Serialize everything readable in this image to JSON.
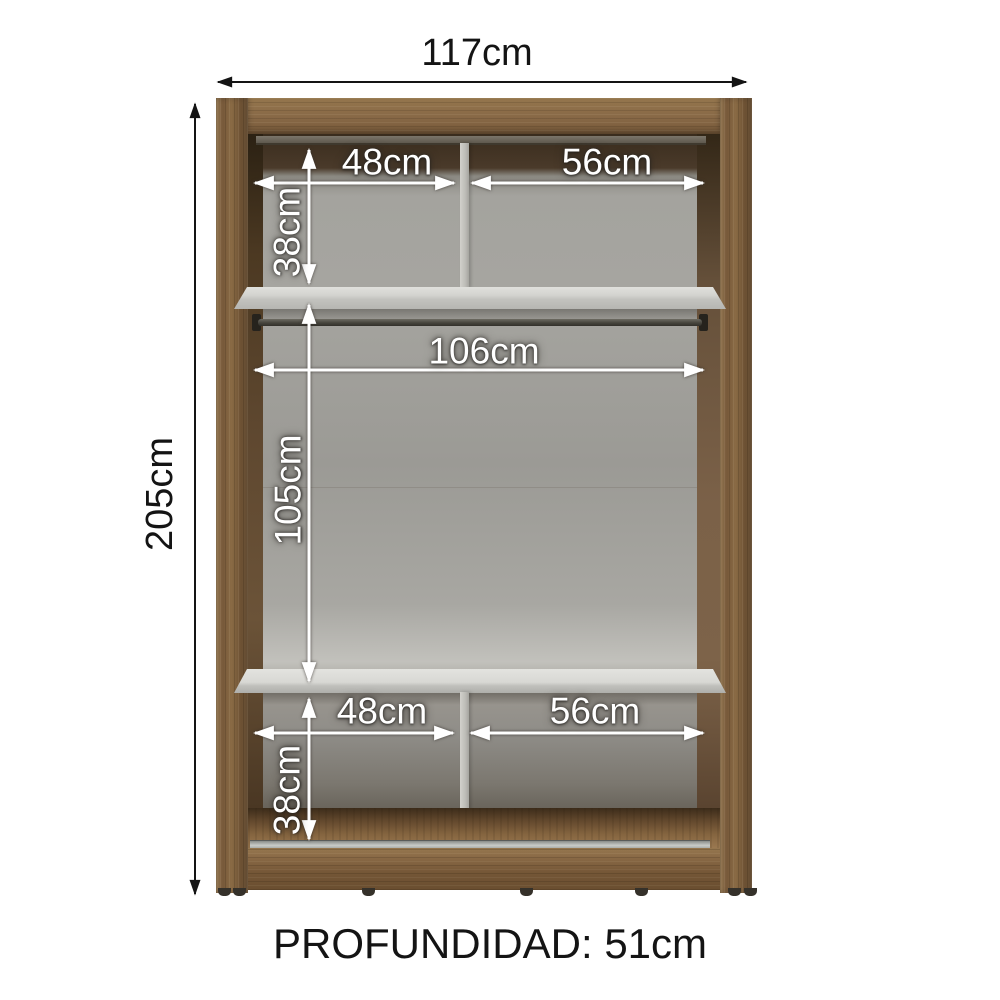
{
  "diagram": {
    "subject": "wardrobe-interior-dimension-diagram",
    "outer": {
      "width": "117cm",
      "height": "205cm",
      "depth": "PROFUNDIDAD: 51cm"
    },
    "top_section": {
      "left_width": "48cm",
      "right_width": "56cm",
      "height": "38cm"
    },
    "middle_section": {
      "rod_width": "106cm",
      "height": "105cm"
    },
    "bottom_section": {
      "left_width": "48cm",
      "right_width": "56cm",
      "height": "38cm"
    }
  },
  "colors": {
    "wood": "#84663f",
    "wood_dark": "#6b4f31",
    "interior_back_gray": "#a1a09b",
    "shelf_white": "#d6d6d2",
    "dimension_text_light": "#ffffff",
    "dimension_text_dark": "#141414",
    "background": "#ffffff"
  }
}
